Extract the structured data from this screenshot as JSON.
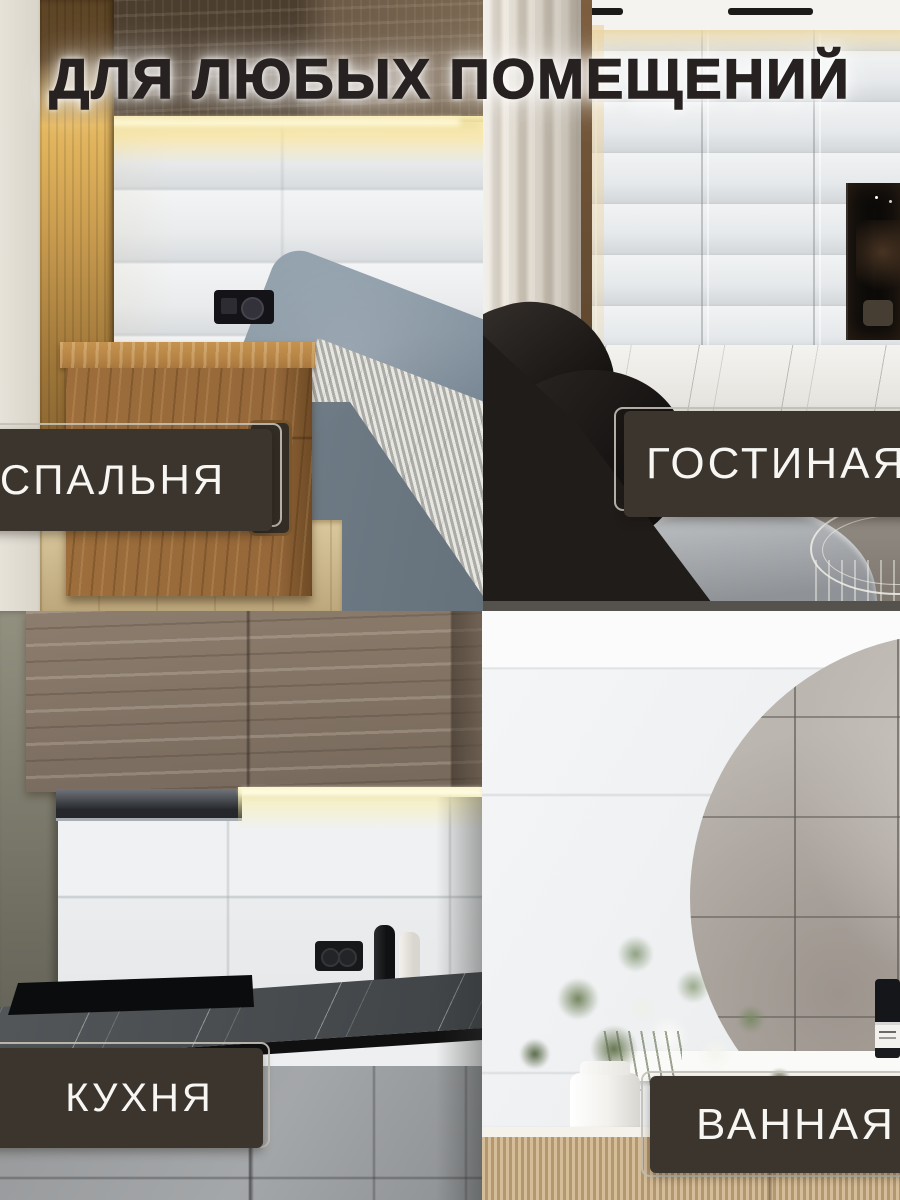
{
  "title": "ДЛЯ ЛЮБЫХ ПОМЕЩЕНИЙ",
  "rooms": {
    "bedroom": {
      "label": "СПАЛЬНЯ"
    },
    "living_room": {
      "label": "ГОСТИНАЯ"
    },
    "kitchen": {
      "label": "КУХНЯ"
    },
    "bathroom": {
      "label": "ВАННАЯ"
    }
  },
  "palette": {
    "label_background": "#3B352E",
    "label_text": "#F7F6F3",
    "label_outline": "#C7C2B8",
    "title_text": "#272221",
    "title_glow": "#FFFFFF",
    "led_glow": "#FFE083",
    "wall_panel": "#E8EAEC"
  }
}
